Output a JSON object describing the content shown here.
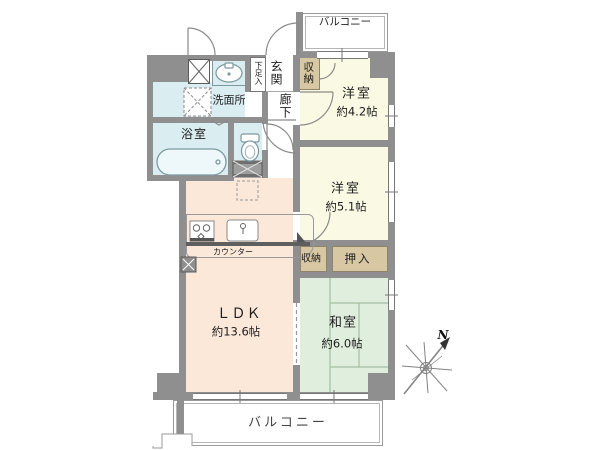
{
  "plan": {
    "balconies": {
      "top": "バルコニー",
      "bottom": "バルコニー"
    },
    "rooms": {
      "western_a": {
        "name": "洋室",
        "size": "約4.2帖"
      },
      "western_b": {
        "name": "洋室",
        "size": "約5.1帖"
      },
      "japanese": {
        "name": "和室",
        "size": "約6.0帖"
      },
      "ldk": {
        "name": "ＬＤＫ",
        "size": "約13.6帖"
      },
      "bathroom": {
        "name": "浴室"
      },
      "washroom": {
        "name": "洗面所"
      },
      "entrance": {
        "name": "玄関"
      },
      "hallway": {
        "name": "廊下"
      }
    },
    "storage": {
      "shoe_cabinet": "下足入",
      "entry_closet": "収納",
      "living_closet": "収納",
      "futon_closet": "押入"
    },
    "kitchen": {
      "counter_label": "カウンター"
    },
    "compass": {
      "north_label": "N"
    },
    "colors": {
      "wall": "#8f8f8f",
      "ldk_floor": "#fbe8d9",
      "western_floor": "#fafae4",
      "tatami_floor": "#dfeedd",
      "wet_area": "#daedf1",
      "closet": "#d8c7a3"
    }
  }
}
